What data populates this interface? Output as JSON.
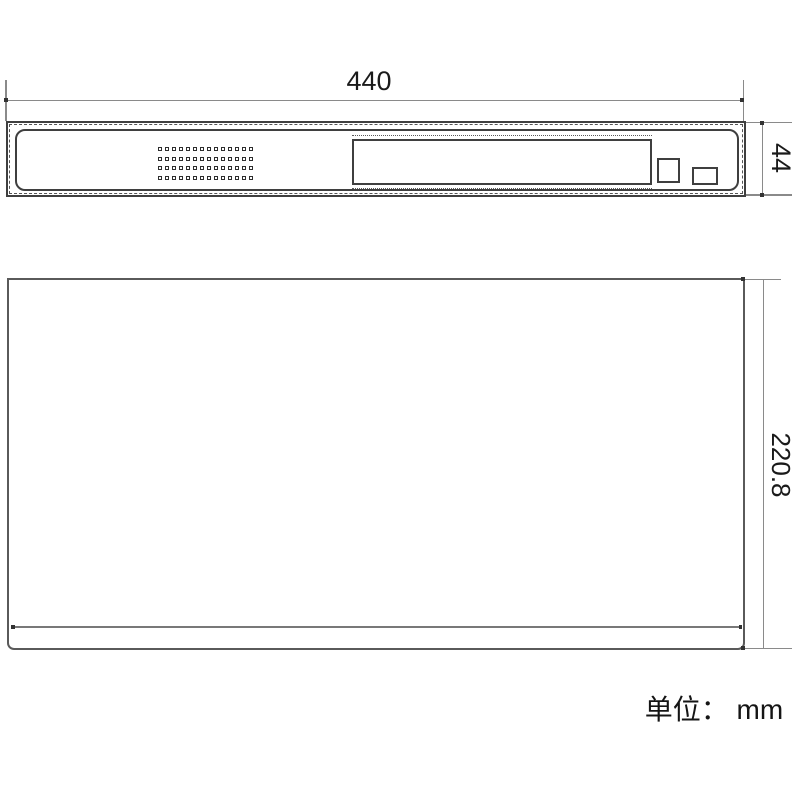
{
  "page": {
    "background": "#ffffff",
    "unit_label": "单位： mm"
  },
  "views": {
    "front": {
      "description": "front-panel-view",
      "grille": {
        "rows": 4,
        "cols": 14
      }
    },
    "top": {
      "description": "top-view"
    }
  },
  "dimensions": {
    "width": {
      "value": "440"
    },
    "height": {
      "value": "44"
    },
    "depth": {
      "value": "220.8"
    }
  },
  "colors": {
    "outline_dark": "#3f3f3f",
    "outline_gray": "#5a5a5a",
    "dimension_line": "#8a8a8a",
    "endpoint_dot": "#333333",
    "text": "#1a1a1a"
  }
}
